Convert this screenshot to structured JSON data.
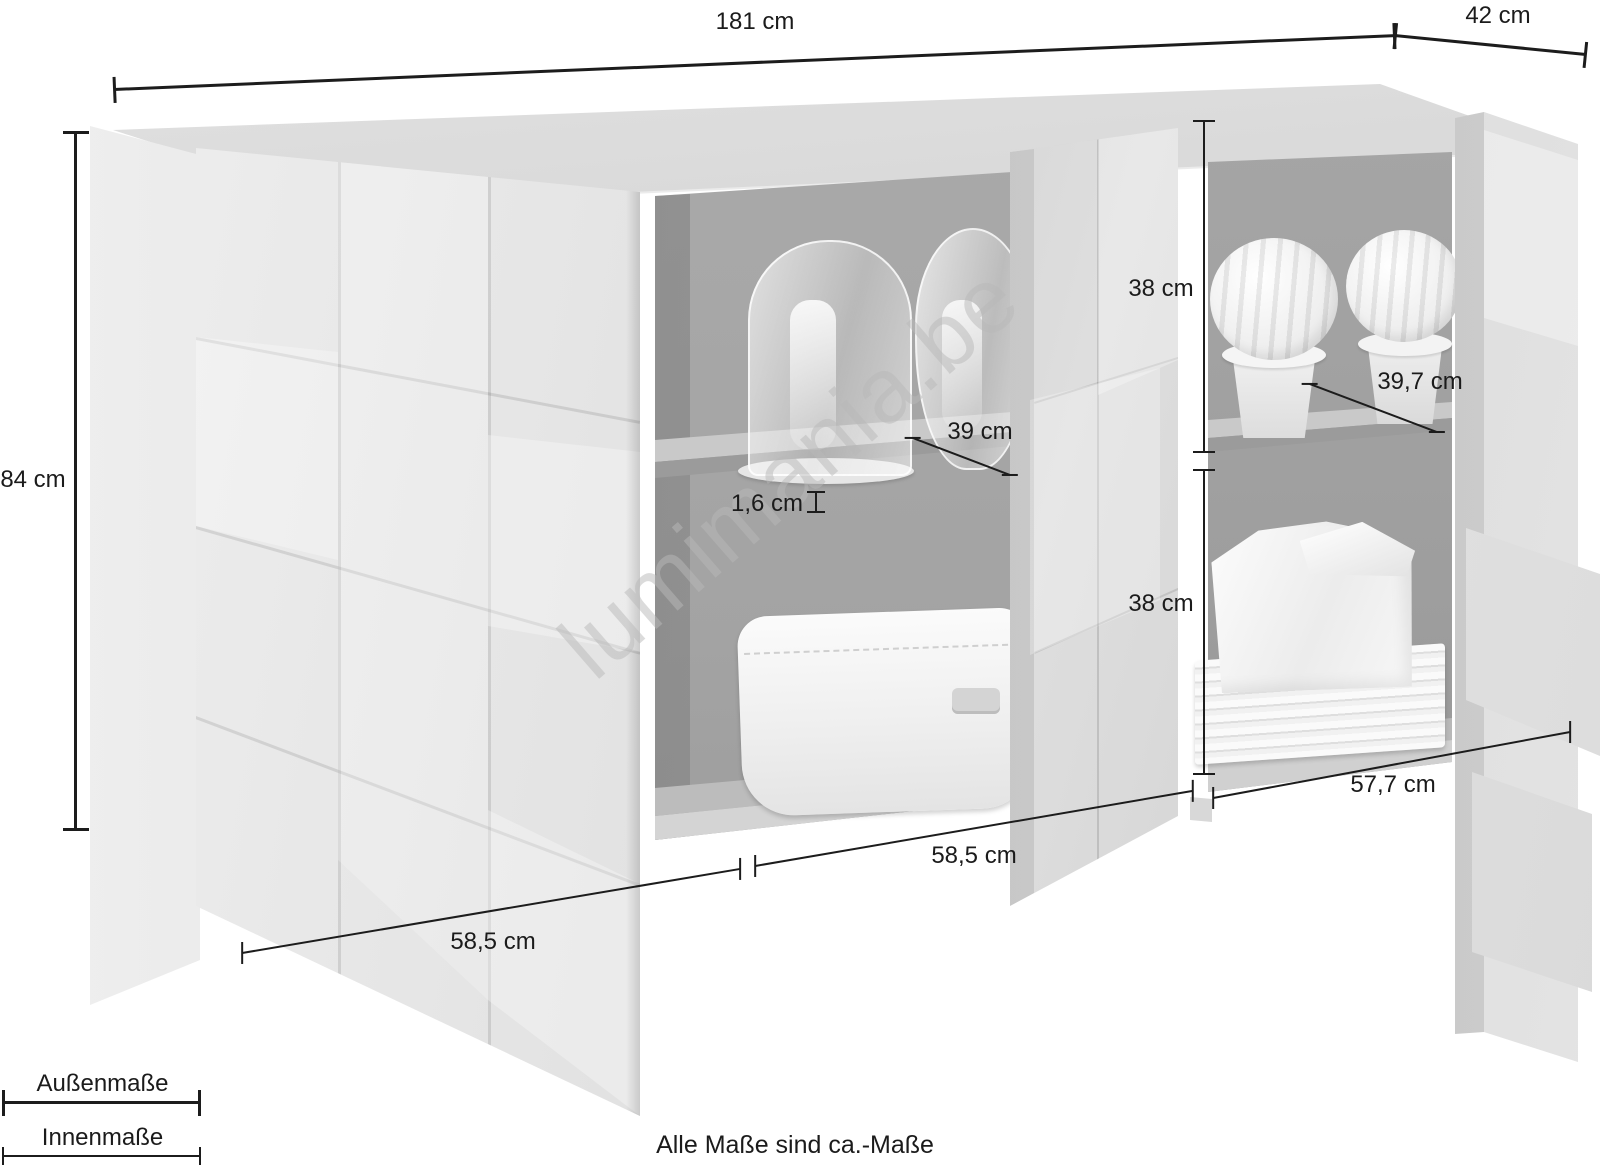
{
  "diagram": {
    "watermark": "lumimania.be",
    "note": "Alle Maße sind ca.-Maße",
    "legend": {
      "outer": "Außenmaße",
      "inner": "Innenmaße"
    },
    "dims": {
      "total_width": "181 cm",
      "depth": "42 cm",
      "height": "84 cm",
      "upper_inner_height": "38 cm",
      "lower_inner_height": "38 cm",
      "inner_depth_left": "39 cm",
      "inner_depth_right": "39,7 cm",
      "shelf_thickness": "1,6 cm",
      "inner_width_left": "58,5 cm",
      "inner_width_middle": "58,5 cm",
      "inner_width_right": "57,7 cm"
    }
  }
}
